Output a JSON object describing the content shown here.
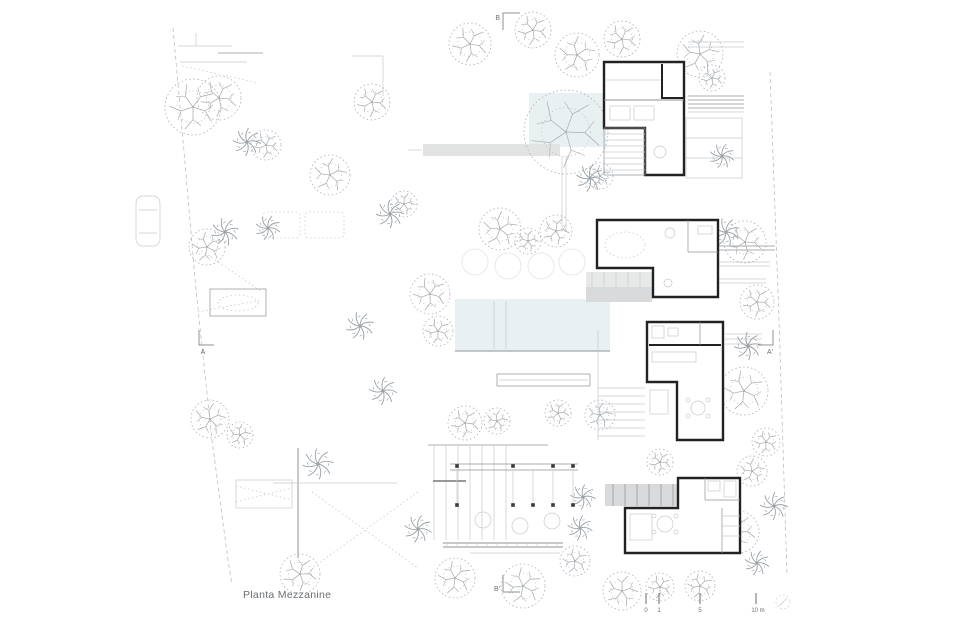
{
  "drawing": {
    "title": "Planta Mezzanine",
    "section_markers": {
      "top": "B",
      "bottom": "B'",
      "left": "A",
      "right": "A'"
    },
    "scale_bar": {
      "tick_labels": [
        "0",
        "1",
        "5",
        "10 m"
      ]
    }
  },
  "colors": {
    "wall": "#222222",
    "line": "#8d9296",
    "faint": "#c6cacd",
    "pool": "#e9f0f2",
    "deck": "#d9dadb",
    "deck_light": "#e7e8e8",
    "tree": "#aeb2b6",
    "palm": "#9aa0a5",
    "text": "#6a6f73",
    "bg": "#ffffff"
  }
}
